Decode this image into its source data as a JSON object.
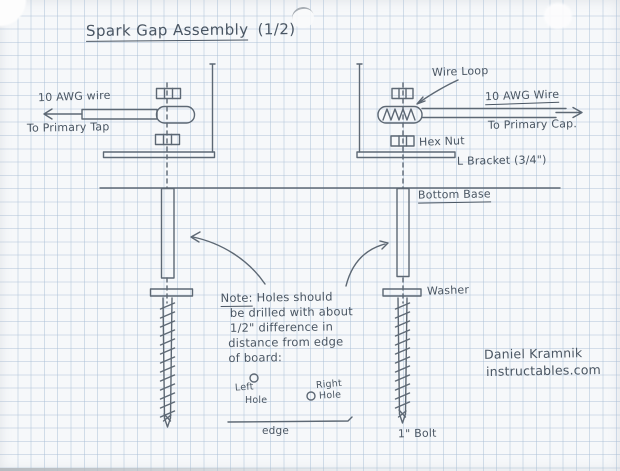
{
  "colors": {
    "paper": "#f6f8fa",
    "grid": "#a9bfd680",
    "ink": "#5d6874",
    "pencil": "#4a5663"
  },
  "title": {
    "text": "Spark Gap Assembly",
    "suffix": "(1/2)"
  },
  "left_assembly": {
    "wire_label": "10 AWG wire",
    "destination": "To Primary Tap"
  },
  "right_assembly": {
    "wire_loop": "Wire Loop",
    "wire_label": "10 AWG Wire",
    "destination": "To Primary Cap.",
    "hex_nut": "Hex Nut",
    "l_bracket": "L Bracket (3/4\")",
    "bottom_base": "Bottom Base",
    "washer": "Washer",
    "bolt": "1\" Bolt"
  },
  "note": {
    "prefix": "Note:",
    "first_line": "Holes should",
    "lines": [
      "be drilled with about",
      "1/2\" difference in",
      "distance from edge",
      "of board:"
    ]
  },
  "holes": {
    "left_line1": "Left",
    "left_line2": "Hole",
    "right_line1": "Right",
    "right_line2": "Hole"
  },
  "edge_label": "edge",
  "signature": {
    "name": "Daniel Kramnik",
    "site": "instructables.com"
  }
}
